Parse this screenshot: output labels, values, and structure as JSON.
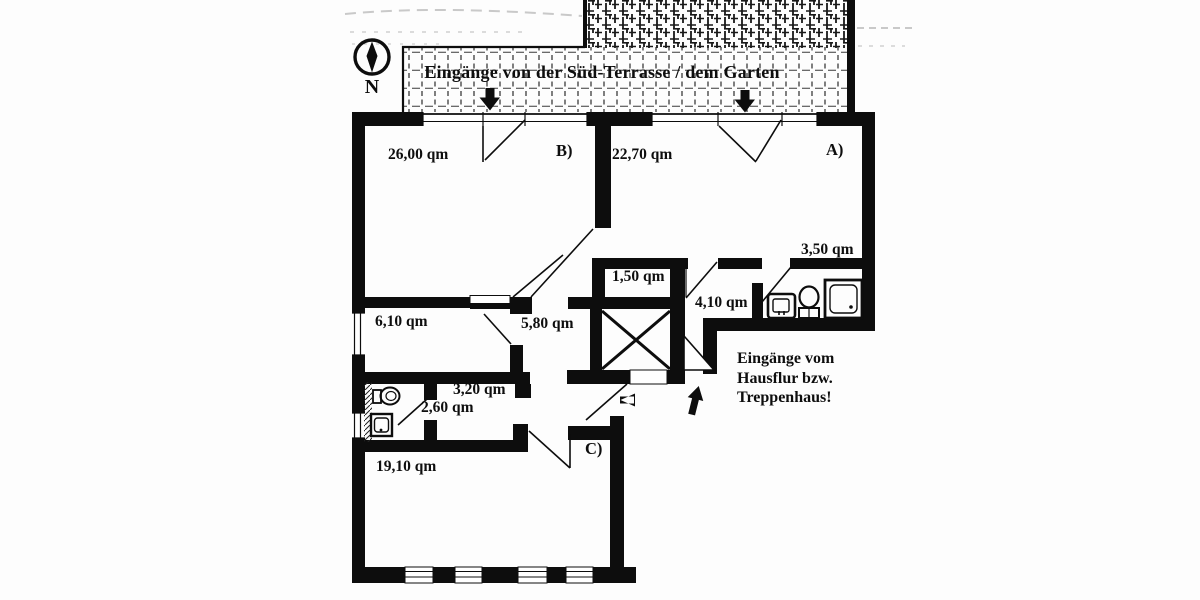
{
  "compass": {
    "north_label": "N"
  },
  "terrace": {
    "banner_text": "Eingänge von der Süd-Terrasse / dem Garten"
  },
  "stairwell_note": {
    "line1": "Eingänge vom",
    "line2": "Hausflur bzw.",
    "line3": "Treppenhaus!"
  },
  "labels": {
    "room_b_area": "26,00 qm",
    "room_b_tag": "B)",
    "room_a_area": "22,70 qm",
    "room_a_tag": "A)",
    "bath_a_area": "3,50 qm",
    "closet_area": "1,50 qm",
    "corridor_a_area": "4,10 qm",
    "room_610_area": "6,10 qm",
    "hall_area": "5,80 qm",
    "corridor_320_area": "3,20 qm",
    "bath_c_area": "2,60 qm",
    "room_c_area": "19,10 qm",
    "room_c_tag": "C)"
  },
  "colors": {
    "ink": "#0d0d0d",
    "paper": "#fdfdfd"
  }
}
